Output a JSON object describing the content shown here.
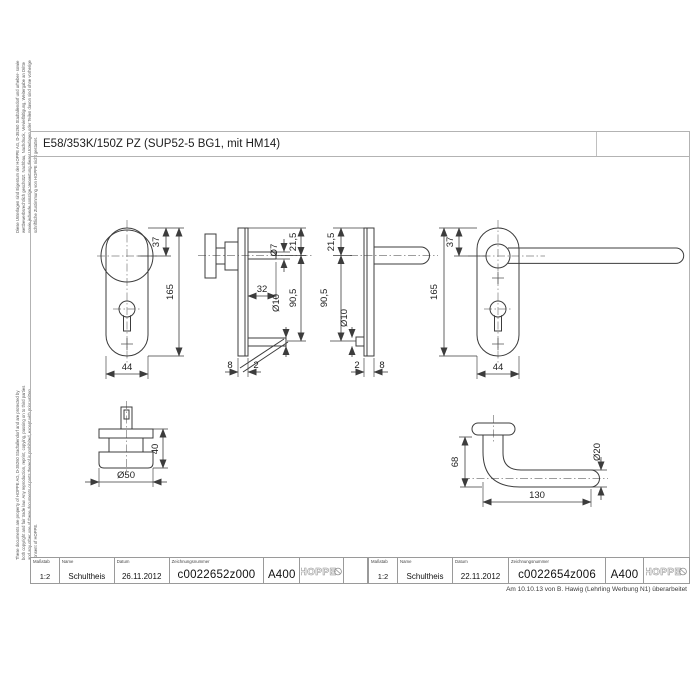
{
  "sheet": {
    "title": "E58/353K/150Z PZ (SUP52-5 BG1, mit HM14)",
    "revision_note": "Am 10.10.13 von B. Hawig (Lehrling Werbung N1) überarbeitet",
    "margin_note_de": "Diese Unterlagen sind Eigentum der HOPPE AG, D-35260 Stadtallendorf und urheber- sowie wettbewerbsrechtlich geschützt. Nachbau, Nachdruck, Vervielfältigung, Weitergabe an Dritte sowie jedwede sonstige Verwertung dieser Unterlagen oder Teilen davon sind ohne vorherige schriftliche Zustimmung von HOPPE nicht gestattet.",
    "margin_note_en": "These documents are property of HOPPE AG, D-35260 Stadtallendorf and are protected by both copyright and fair trade law. Any reproduction, reprint, copying, passing on to third parties and any other use of these documents or parts thereof is prohibited, except with prior written consent of HOPPE."
  },
  "labels": {
    "scale": "Maßstab",
    "name": "Name",
    "date": "Datum",
    "drawing_no": "Zeichnungsnummer"
  },
  "blocks": [
    {
      "scale": "1:2",
      "name": "Schultheis",
      "date": "26.11.2012",
      "drawing_no": "c0022652z000",
      "format": "A400",
      "logo": "HOPPE"
    },
    {
      "scale": "1:2",
      "name": "Schultheis",
      "date": "22.11.2012",
      "drawing_no": "c0022654z006",
      "format": "A400",
      "logo": "HOPPE"
    }
  ],
  "dims": {
    "knob_plate": {
      "top": "37",
      "height": "165",
      "width": "44"
    },
    "knob_side": {
      "spindle": "Ø7",
      "offset_top": "21,5",
      "spindle_len": "32",
      "screw": "Ø10",
      "offset_pz": "90,5",
      "plate": "8",
      "cover": "2"
    },
    "lever_side": {
      "offset_top": "21,5",
      "offset_pz": "90,5",
      "screw": "Ø10",
      "cover": "2",
      "plate": "8"
    },
    "lever_plate": {
      "top": "37",
      "height": "165",
      "width": "44"
    },
    "knob": {
      "height": "40",
      "dia": "Ø50"
    },
    "lever": {
      "height": "68",
      "length": "130",
      "dia": "Ø20"
    }
  },
  "colors": {
    "line": "#3c3c3c",
    "frame": "#b3b3b3",
    "text": "#1d1d1d"
  }
}
